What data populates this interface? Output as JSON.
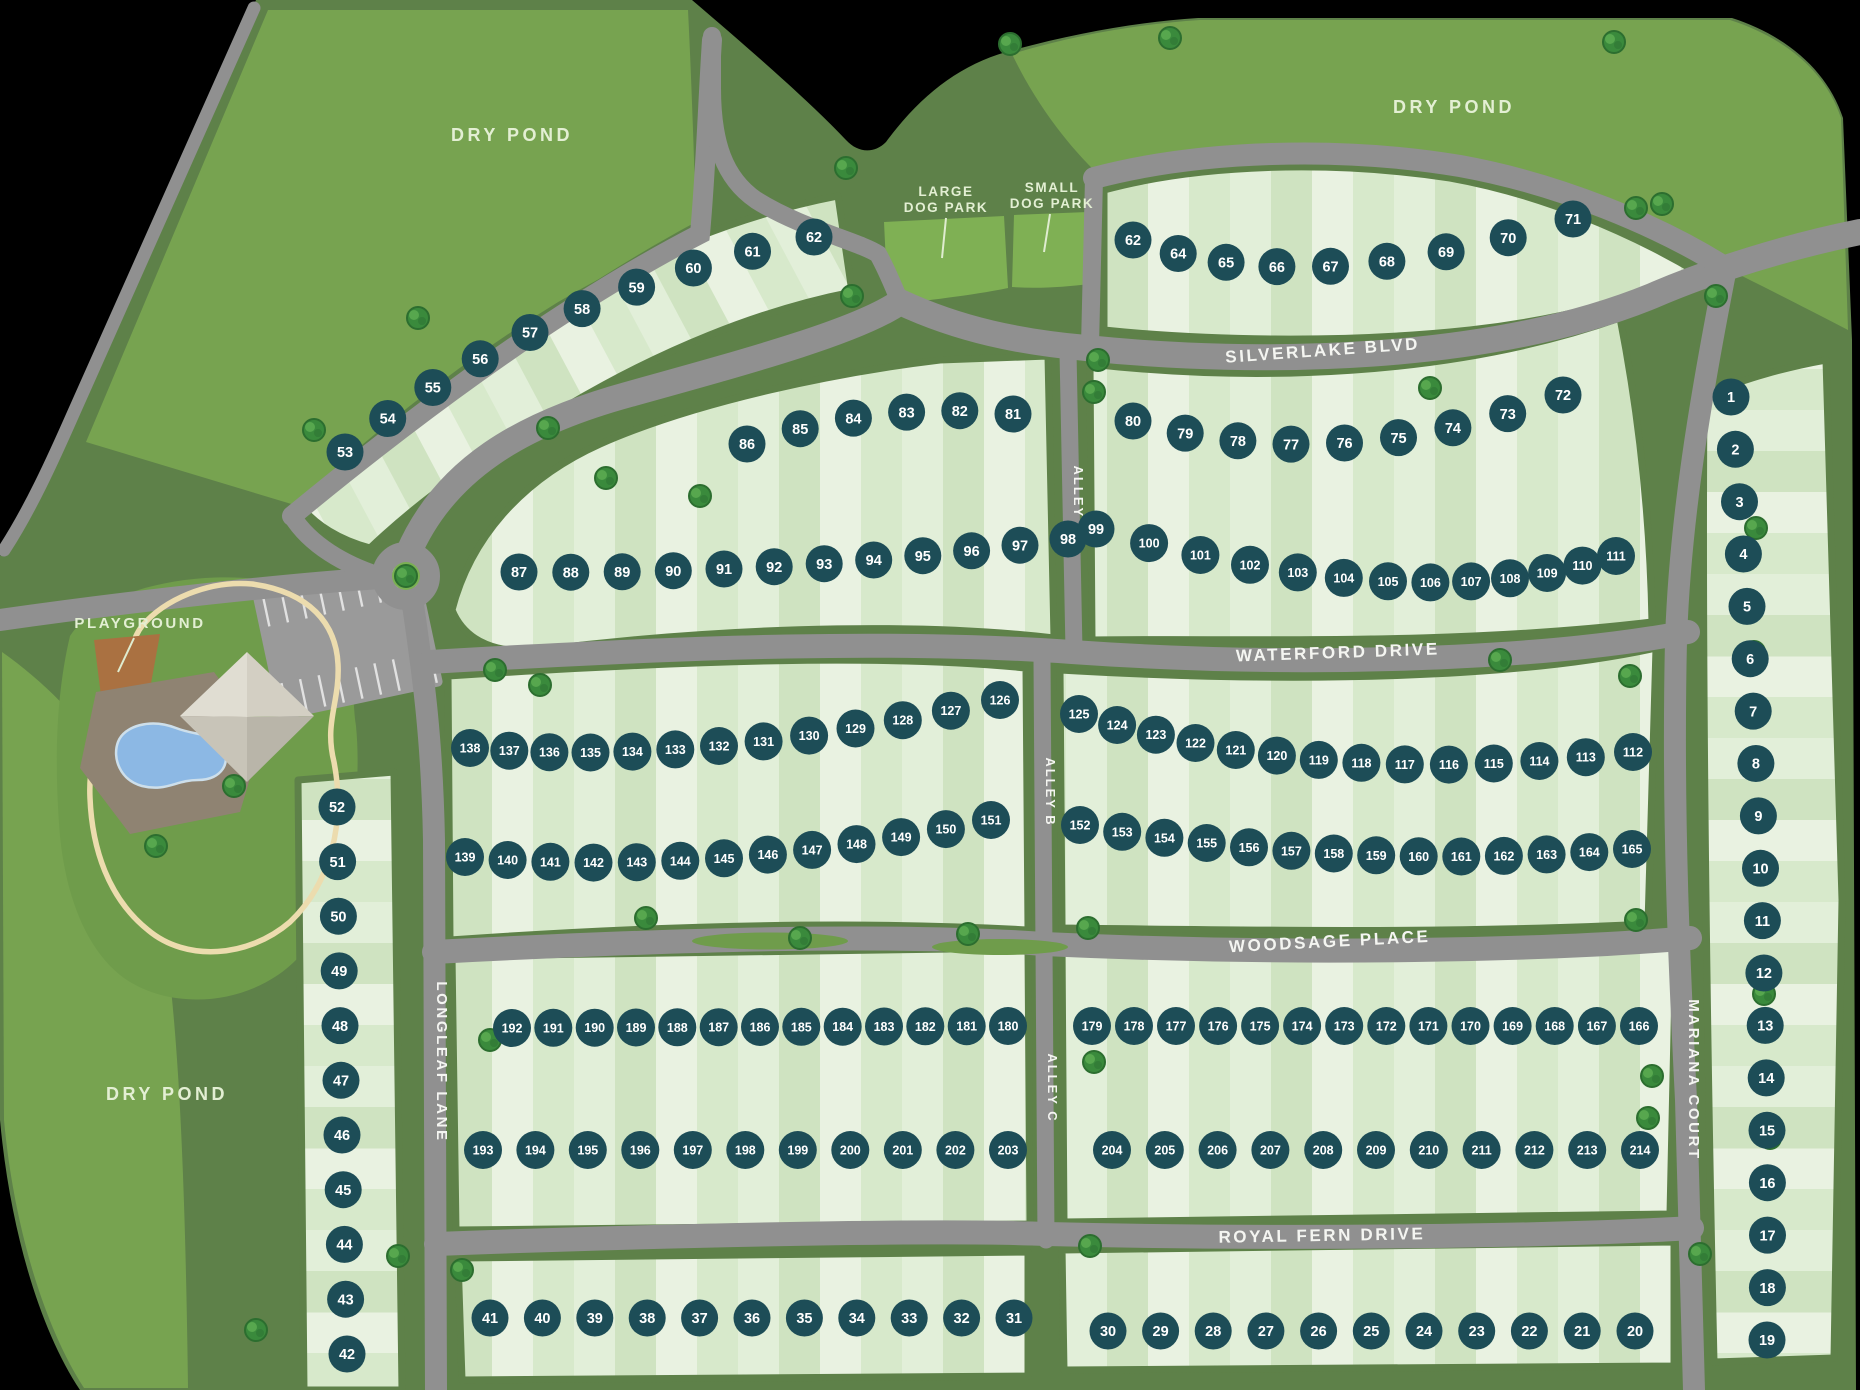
{
  "map": {
    "areas": {
      "dry_pond_nw": "DRY POND",
      "dry_pond_ne": "DRY POND",
      "dry_pond_sw": "DRY POND",
      "playground": "PLAYGROUND",
      "large_dog_park_line1": "LARGE",
      "large_dog_park_line2": "DOG PARK",
      "small_dog_park_line1": "SMALL",
      "small_dog_park_line2": "DOG PARK"
    },
    "streets": {
      "silverlake": "SILVERLAKE BLVD",
      "waterford": "WATERFORD DRIVE",
      "woodsage": "WOODSAGE PLACE",
      "royal_fern": "ROYAL FERN DRIVE",
      "longleaf": "LONGLEAF LANE",
      "mariana": "MARIANA COURT",
      "alley_a": "ALLEY A",
      "alley_b": "ALLEY B",
      "alley_c": "ALLEY C"
    },
    "lots": {
      "rows": [
        {
          "id": "arc-nw",
          "numbers": [
            53,
            54,
            55,
            56,
            57,
            58,
            59,
            60,
            61,
            62
          ]
        },
        {
          "id": "arc-ne",
          "numbers": [
            62,
            64,
            65,
            66,
            67,
            68,
            69,
            70,
            71
          ]
        },
        {
          "id": "silverlake-south-west",
          "numbers": [
            86,
            85,
            84,
            83,
            82,
            81
          ]
        },
        {
          "id": "silverlake-south-east",
          "numbers": [
            80,
            79,
            78,
            77,
            76,
            75,
            74,
            73,
            72
          ]
        },
        {
          "id": "waterford-north-west",
          "numbers": [
            87,
            88,
            89,
            90,
            91,
            92,
            93,
            94,
            95,
            96,
            97,
            98
          ]
        },
        {
          "id": "waterford-north-east",
          "numbers": [
            99,
            100,
            101,
            102,
            103,
            104,
            105,
            106,
            107,
            108,
            109,
            110,
            111
          ]
        },
        {
          "id": "waterford-south-east",
          "numbers": [
            125,
            124,
            123,
            122,
            121,
            120,
            119,
            118,
            117,
            116,
            115,
            114,
            113,
            112
          ]
        },
        {
          "id": "waterford-south-west",
          "numbers": [
            138,
            137,
            136,
            135,
            134,
            133,
            132,
            131,
            130,
            129,
            128,
            127,
            126
          ]
        },
        {
          "id": "woodsage-north-west",
          "numbers": [
            139,
            140,
            141,
            142,
            143,
            144,
            145,
            146,
            147,
            148,
            149,
            150,
            151
          ]
        },
        {
          "id": "woodsage-north-east",
          "numbers": [
            152,
            153,
            154,
            155,
            156,
            157,
            158,
            159,
            160,
            161,
            162,
            163,
            164,
            165
          ]
        },
        {
          "id": "woodsage-south-west",
          "numbers": [
            192,
            191,
            190,
            189,
            188,
            187,
            186,
            185,
            184,
            183,
            182,
            181,
            180
          ]
        },
        {
          "id": "woodsage-south-east",
          "numbers": [
            179,
            178,
            177,
            176,
            175,
            174,
            173,
            172,
            171,
            170,
            169,
            168,
            167,
            166
          ]
        },
        {
          "id": "royalfern-north-west",
          "numbers": [
            193,
            194,
            195,
            196,
            197,
            198,
            199,
            200,
            201,
            202,
            203
          ]
        },
        {
          "id": "royalfern-north-east",
          "numbers": [
            204,
            205,
            206,
            207,
            208,
            209,
            210,
            211,
            212,
            213,
            214
          ]
        },
        {
          "id": "royalfern-south-west",
          "numbers": [
            41,
            40,
            39,
            38,
            37,
            36,
            35,
            34,
            33,
            32,
            31
          ]
        },
        {
          "id": "royalfern-south-east",
          "numbers": [
            30,
            29,
            28,
            27,
            26,
            25,
            24,
            23,
            22,
            21,
            20
          ]
        },
        {
          "id": "longleaf-west-column",
          "numbers": [
            52,
            51,
            50,
            49,
            48,
            47,
            46,
            45,
            44,
            43,
            42
          ]
        },
        {
          "id": "mariana-east-column",
          "numbers": [
            1,
            2,
            3,
            4,
            5,
            6,
            7,
            8,
            9,
            10,
            11,
            12,
            13,
            14,
            15,
            16,
            17,
            18,
            19
          ]
        }
      ]
    },
    "colors": {
      "lot_marker": "#1d4d57",
      "lot_number": "#ffffff",
      "road": "#909090",
      "buffer_green": "#5e8149",
      "open_green": "#77a350",
      "amenity_green": "#6f9c4b",
      "dog_park_green": "#7fb054",
      "street_label": "#f4f5f1",
      "area_label": "#e3efd3",
      "pool_blue": "#8cb8e4",
      "playground_brown": "#aa7141",
      "path_tan": "#ecdcae"
    },
    "icons": {
      "tree": "tree-icon",
      "roundabout": "roundabout-icon",
      "pool": "pool-icon",
      "clubhouse": "clubhouse-icon",
      "parking": "parking-lot-icon",
      "playground": "playground-icon"
    }
  }
}
